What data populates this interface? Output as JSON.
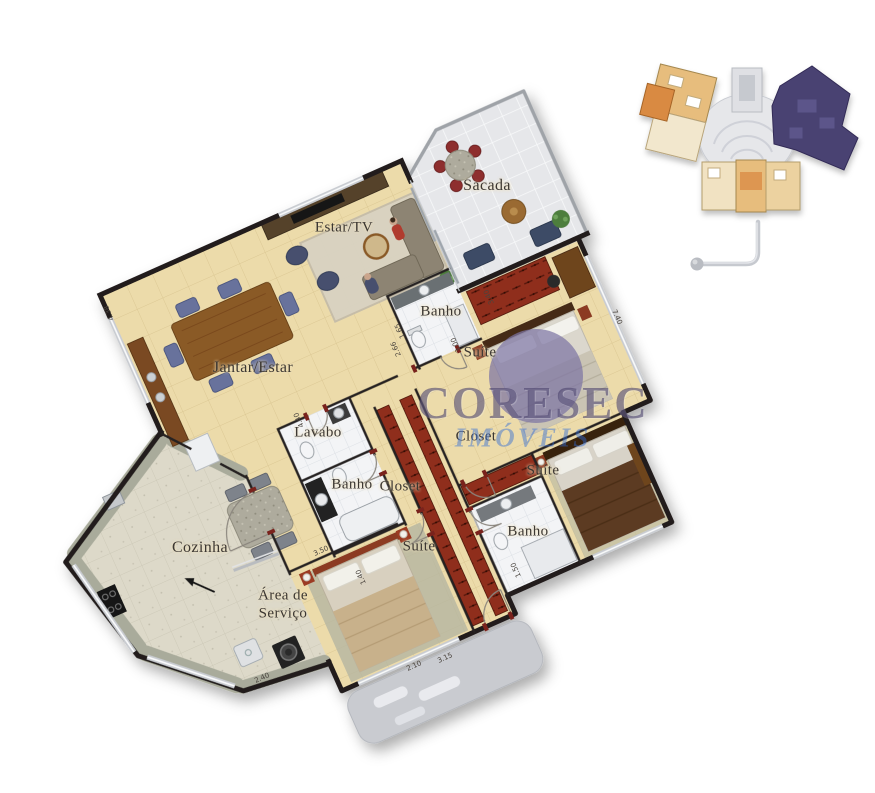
{
  "image": {
    "type": "apartment floor plan render",
    "background": "#ffffff"
  },
  "watermark": {
    "line1": "CORESEC",
    "line2": "IMÓVEIS",
    "line1_color": "#483f6a",
    "line2_color": "#2f6bd7"
  },
  "unit_plan": {
    "rooms": [
      {
        "label": "Sacada"
      },
      {
        "label": "Estar/TV"
      },
      {
        "label": "Banho"
      },
      {
        "label": "Suíte"
      },
      {
        "label": "Jantar/Estar"
      },
      {
        "label": "Lavabo"
      },
      {
        "label": "Closet"
      },
      {
        "label": "Suíte"
      },
      {
        "label": "Banho"
      },
      {
        "label": "Closet"
      },
      {
        "label": "Banho"
      },
      {
        "label": "Cozinha"
      },
      {
        "label": "Suíte"
      },
      {
        "label": "Área de Serviço",
        "line1": "Área de",
        "line2": "Serviço"
      }
    ],
    "dimensions": [
      {
        "text": "4.38"
      },
      {
        "text": "2.66"
      },
      {
        "text": "1.65"
      },
      {
        "text": "3.40"
      },
      {
        "text": "3.00"
      },
      {
        "text": "7.40"
      },
      {
        "text": "4.40"
      },
      {
        "text": "3.50"
      },
      {
        "text": "1.40"
      },
      {
        "text": "1.50"
      },
      {
        "text": "3.15"
      },
      {
        "text": "2.40"
      },
      {
        "text": "2.10"
      }
    ]
  },
  "overview_inset": {
    "description": "building floor overview with highlighted unit",
    "highlight_color": "#4a4272"
  },
  "colors": {
    "floor_beige": "#ecdbaa",
    "balcony_tile": "#e7e8ea",
    "bath_tile": "#f3f4f6",
    "kitchen_floor": "#ddd9c9",
    "granite": "#a9ab9b",
    "wardrobe_red": "#8f2f1e",
    "wood": "#8a5a28",
    "wall": "#201d1a",
    "navy": "#3d4b66",
    "chair_red": "#8e2f2f"
  }
}
